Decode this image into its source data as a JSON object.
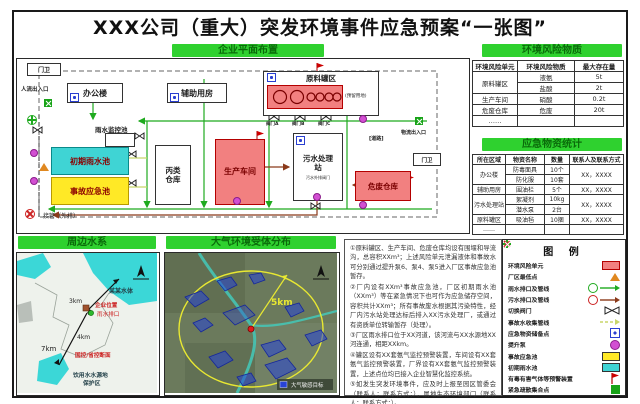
{
  "title": "XXX公司（重大）突发环境事件应急预案“一张图”",
  "tags": {
    "plan": "企业平面布置",
    "risk": "环境风险物质",
    "supplies": "应急物资统计",
    "water": "周边水系",
    "air": "大气环境受体分布"
  },
  "plan": {
    "guard1": "门卫",
    "people_gate": "人流出入口",
    "office": "办公楼",
    "aux": "辅助用房",
    "tank": "原料罐区",
    "reserved": "(预留用地)",
    "valve_a": "阀门A",
    "valve_b": "阀门B",
    "valve_c": "阀门C",
    "rain_monitor": "雨水监控池",
    "initial_rain": "初期雨水池",
    "accident_pool": "事故应急池",
    "warehouse_c": "丙类仓库",
    "workshop": "生产车间",
    "sewage": "污水处理站",
    "sewage_valve": "污水外排阀门",
    "hazwaste": "危废仓库",
    "road": "[道路]",
    "logistics_gate": "物流出入口",
    "guard2": "门卫",
    "outfall": "接管（外排）"
  },
  "risk_table": {
    "headers": [
      "环境风险单元",
      "环境风险物质",
      "最大存在量"
    ],
    "r0": {
      "unit": "原料罐区",
      "mat": "液氨",
      "qty": "5t"
    },
    "r1": {
      "mat": "盐酸",
      "qty": "2t"
    },
    "r2": {
      "unit": "生产车间",
      "mat": "硝酸",
      "qty": "0.2t"
    },
    "r3": {
      "unit": "危废仓库",
      "mat": "危废",
      "qty": "20t"
    },
    "r4": {
      "unit": "……"
    }
  },
  "supplies_table": {
    "headers": [
      "所在区域",
      "物资名称",
      "数量",
      "联系人及联系方式"
    ],
    "s0": {
      "area": "办公楼",
      "name": "防毒面具",
      "qty": "10个",
      "contact": "XX，XXXX"
    },
    "s1": {
      "name": "防化服",
      "qty": "10套"
    },
    "s2": {
      "area": "辅助用房",
      "name": "围油栏",
      "qty": "5个",
      "contact": "XX，XXXX"
    },
    "s3": {
      "area": "污水处理站",
      "name": "絮凝剂",
      "qty": "10kg",
      "contact": "XX，XXXX"
    },
    "s4": {
      "name": "潜水泵",
      "qty": "2台"
    },
    "s5": {
      "area": "原料罐区",
      "name": "吸油毡",
      "qty": "10捆",
      "contact": "XX，XXXX"
    },
    "s6": {
      "area": "……"
    }
  },
  "water_map": {
    "body": "某某水体",
    "company": "企业位置",
    "outlet": "雨水排口",
    "d_top": "3km",
    "d_mid": "4km",
    "d_left": "7km",
    "section": "国控/省控断面",
    "source1": "饮用水水源地",
    "source2": "保护区",
    "north": "N"
  },
  "air_map": {
    "radius": "5km",
    "mini_legend": "大气敏感目标",
    "north": "N"
  },
  "notes": {
    "lines": [
      "①原料罐区、生产车间、危废仓库均设有围堰和导流沟，总容积XXm³；上述风险单元泄漏液体和事故水可分别通过提升泵6、泵4、泵5进入厂区事故应急池暂存。",
      "②厂内设有XXm³事故应急池，厂区初期雨水池（XXm³）等在紧急情况下也可作为应急储存空间，容积共计XXm³；所有事故废水根据其污染特性，经厂内污水站处理达标后排入XX污水处理厂，或通过有资质单位转输暂存（处理）。",
      "③厂区雨水排口位于XX河道，该河流与XX水源地XX河连通，相距XXkm。",
      "④罐区设有XX套氨气监控预警装置，车间设有XX套氨气监控预警装置，厂界设有XX套氨气监控预警装置，上述点位均已接入企业智慧化监控系统。",
      "⑤如发生突发环境事件，应及时上报至园区管委会（联系人；联系方式；），属地生态环境部门（联系人；联系方式；）。",
      "……"
    ]
  },
  "legend": {
    "title": "图  例",
    "items": [
      "环境风险单元",
      "厂区最低点",
      "雨水排口及管线",
      "污水排口及管线",
      "切换阀门",
      "事故水收集管线",
      "应急物资储备点",
      "提升泵",
      "事故应急池",
      "初期雨水池",
      "有毒有害气体等预警装置",
      "紧急疏散集合点"
    ]
  },
  "colors": {
    "tag_green": "#2fd12f",
    "risk_red": "#f28080",
    "pool_cyan": "#3fd4d4",
    "pool_yellow": "#ffe926",
    "pipe_green": "#1faa1f",
    "pipe_brown": "#8b3a1a",
    "pump_magenta": "#d24fd2"
  }
}
